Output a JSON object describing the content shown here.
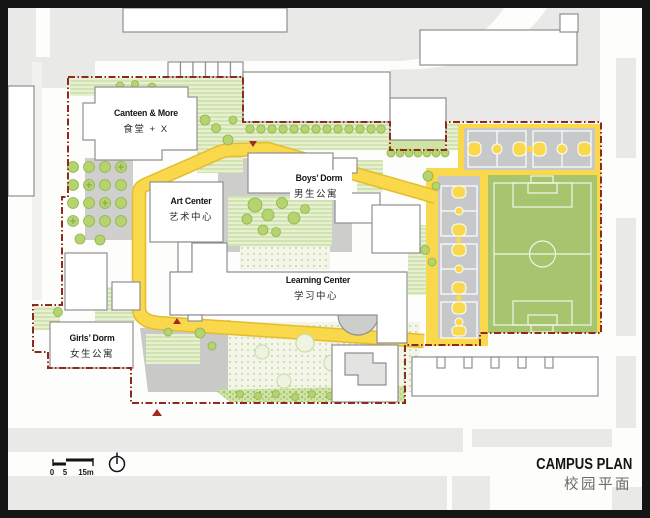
{
  "page": {
    "type": "architectural-campus-site-plan"
  },
  "title": {
    "en": "CAMPUS PLAN",
    "zh": "校园平面"
  },
  "buildings": {
    "canteen": {
      "en": "Canteen & More",
      "zh": "食堂 + X"
    },
    "art_center": {
      "en": "Art Center",
      "zh": "艺术中心"
    },
    "boys_dorm": {
      "en": "Boys’ Dorm",
      "zh": "男生公寓"
    },
    "learning_center": {
      "en": "Learning Center",
      "zh": "学习中心"
    },
    "girls_dorm": {
      "en": "Girls’ Dorm",
      "zh": "女生公寓"
    }
  },
  "scale_bar": {
    "tick0": "0",
    "tick5": "5",
    "tick15": "15m"
  },
  "icons": {
    "north": "north-indicator-icon"
  },
  "colors": {
    "boundary_red": "#8E2A1C",
    "path_yellow": "#F9D84B",
    "path_edge_yellow": "#E4BD2F",
    "field_green": "#A6C56E",
    "court_gray": "#C6C8CA",
    "context_gray": "#E9E9E8",
    "plaza_gray": "#C9C9C7",
    "vegetation_green": "#CFE3A4",
    "frame_black": "#151515"
  }
}
